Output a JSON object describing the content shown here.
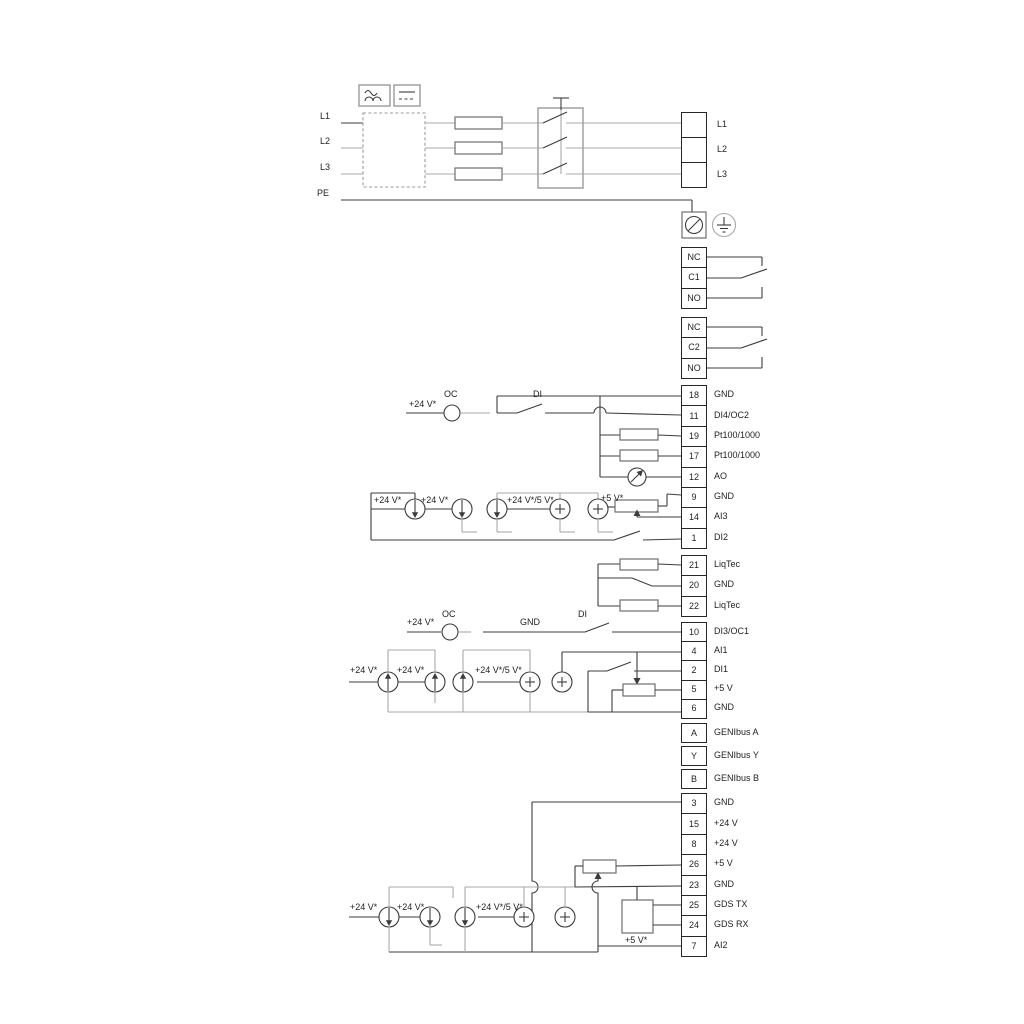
{
  "diagram": {
    "power": {
      "left_labels": [
        "L1",
        "L2",
        "L3",
        "PE"
      ]
    },
    "terminals": {
      "power": [
        "L1",
        "L2",
        "L3"
      ],
      "relay1": [
        "NC",
        "C1",
        "NO"
      ],
      "relay2": [
        "NC",
        "C2",
        "NO"
      ],
      "io1": [
        [
          "18",
          "GND"
        ],
        [
          "11",
          "DI4/OC2"
        ],
        [
          "19",
          "Pt100/1000"
        ],
        [
          "17",
          "Pt100/1000"
        ],
        [
          "12",
          "AO"
        ],
        [
          "9",
          "GND"
        ],
        [
          "14",
          "AI3"
        ],
        [
          "1",
          "DI2"
        ]
      ],
      "liqtec": [
        [
          "21",
          "LiqTec"
        ],
        [
          "20",
          "GND"
        ],
        [
          "22",
          "LiqTec"
        ]
      ],
      "io2": [
        [
          "10",
          "DI3/OC1"
        ],
        [
          "4",
          "AI1"
        ],
        [
          "2",
          "DI1"
        ],
        [
          "5",
          "+5 V"
        ],
        [
          "6",
          "GND"
        ]
      ],
      "genibus": [
        [
          "A",
          "GENIbus A"
        ],
        [
          "Y",
          "GENIbus Y"
        ],
        [
          "B",
          "GENIbus B"
        ]
      ],
      "bottom": [
        [
          "3",
          "GND"
        ],
        [
          "15",
          "+24 V"
        ],
        [
          "8",
          "+24 V"
        ],
        [
          "26",
          "+5 V"
        ],
        [
          "23",
          "GND"
        ],
        [
          "25",
          "GDS TX"
        ],
        [
          "24",
          "GDS RX"
        ],
        [
          "7",
          "AI2"
        ]
      ]
    },
    "annotations": [
      {
        "text": "+24 V*",
        "x": 409,
        "y": 400
      },
      {
        "text": "OC",
        "x": 444,
        "y": 390
      },
      {
        "text": "DI",
        "x": 533,
        "y": 390
      },
      {
        "text": "+24 V*",
        "x": 374,
        "y": 496
      },
      {
        "text": "+24 V*",
        "x": 421,
        "y": 496
      },
      {
        "text": "+24 V*/5 V*",
        "x": 507,
        "y": 496
      },
      {
        "text": "+5 V*",
        "x": 601,
        "y": 494
      },
      {
        "text": "+24 V*",
        "x": 407,
        "y": 618
      },
      {
        "text": "OC",
        "x": 442,
        "y": 610
      },
      {
        "text": "GND",
        "x": 520,
        "y": 618
      },
      {
        "text": "DI",
        "x": 578,
        "y": 610
      },
      {
        "text": "+24 V*",
        "x": 350,
        "y": 666
      },
      {
        "text": "+24 V*",
        "x": 397,
        "y": 666
      },
      {
        "text": "+24 V*/5 V*",
        "x": 475,
        "y": 666
      },
      {
        "text": "+24 V*",
        "x": 350,
        "y": 903
      },
      {
        "text": "+24 V*",
        "x": 397,
        "y": 903
      },
      {
        "text": "+24 V*/5 V*",
        "x": 476,
        "y": 903
      },
      {
        "text": "+5 V*",
        "x": 625,
        "y": 936
      }
    ],
    "colors": {
      "wire": "#3c3c3c",
      "gray": "#a8a8a8"
    }
  }
}
